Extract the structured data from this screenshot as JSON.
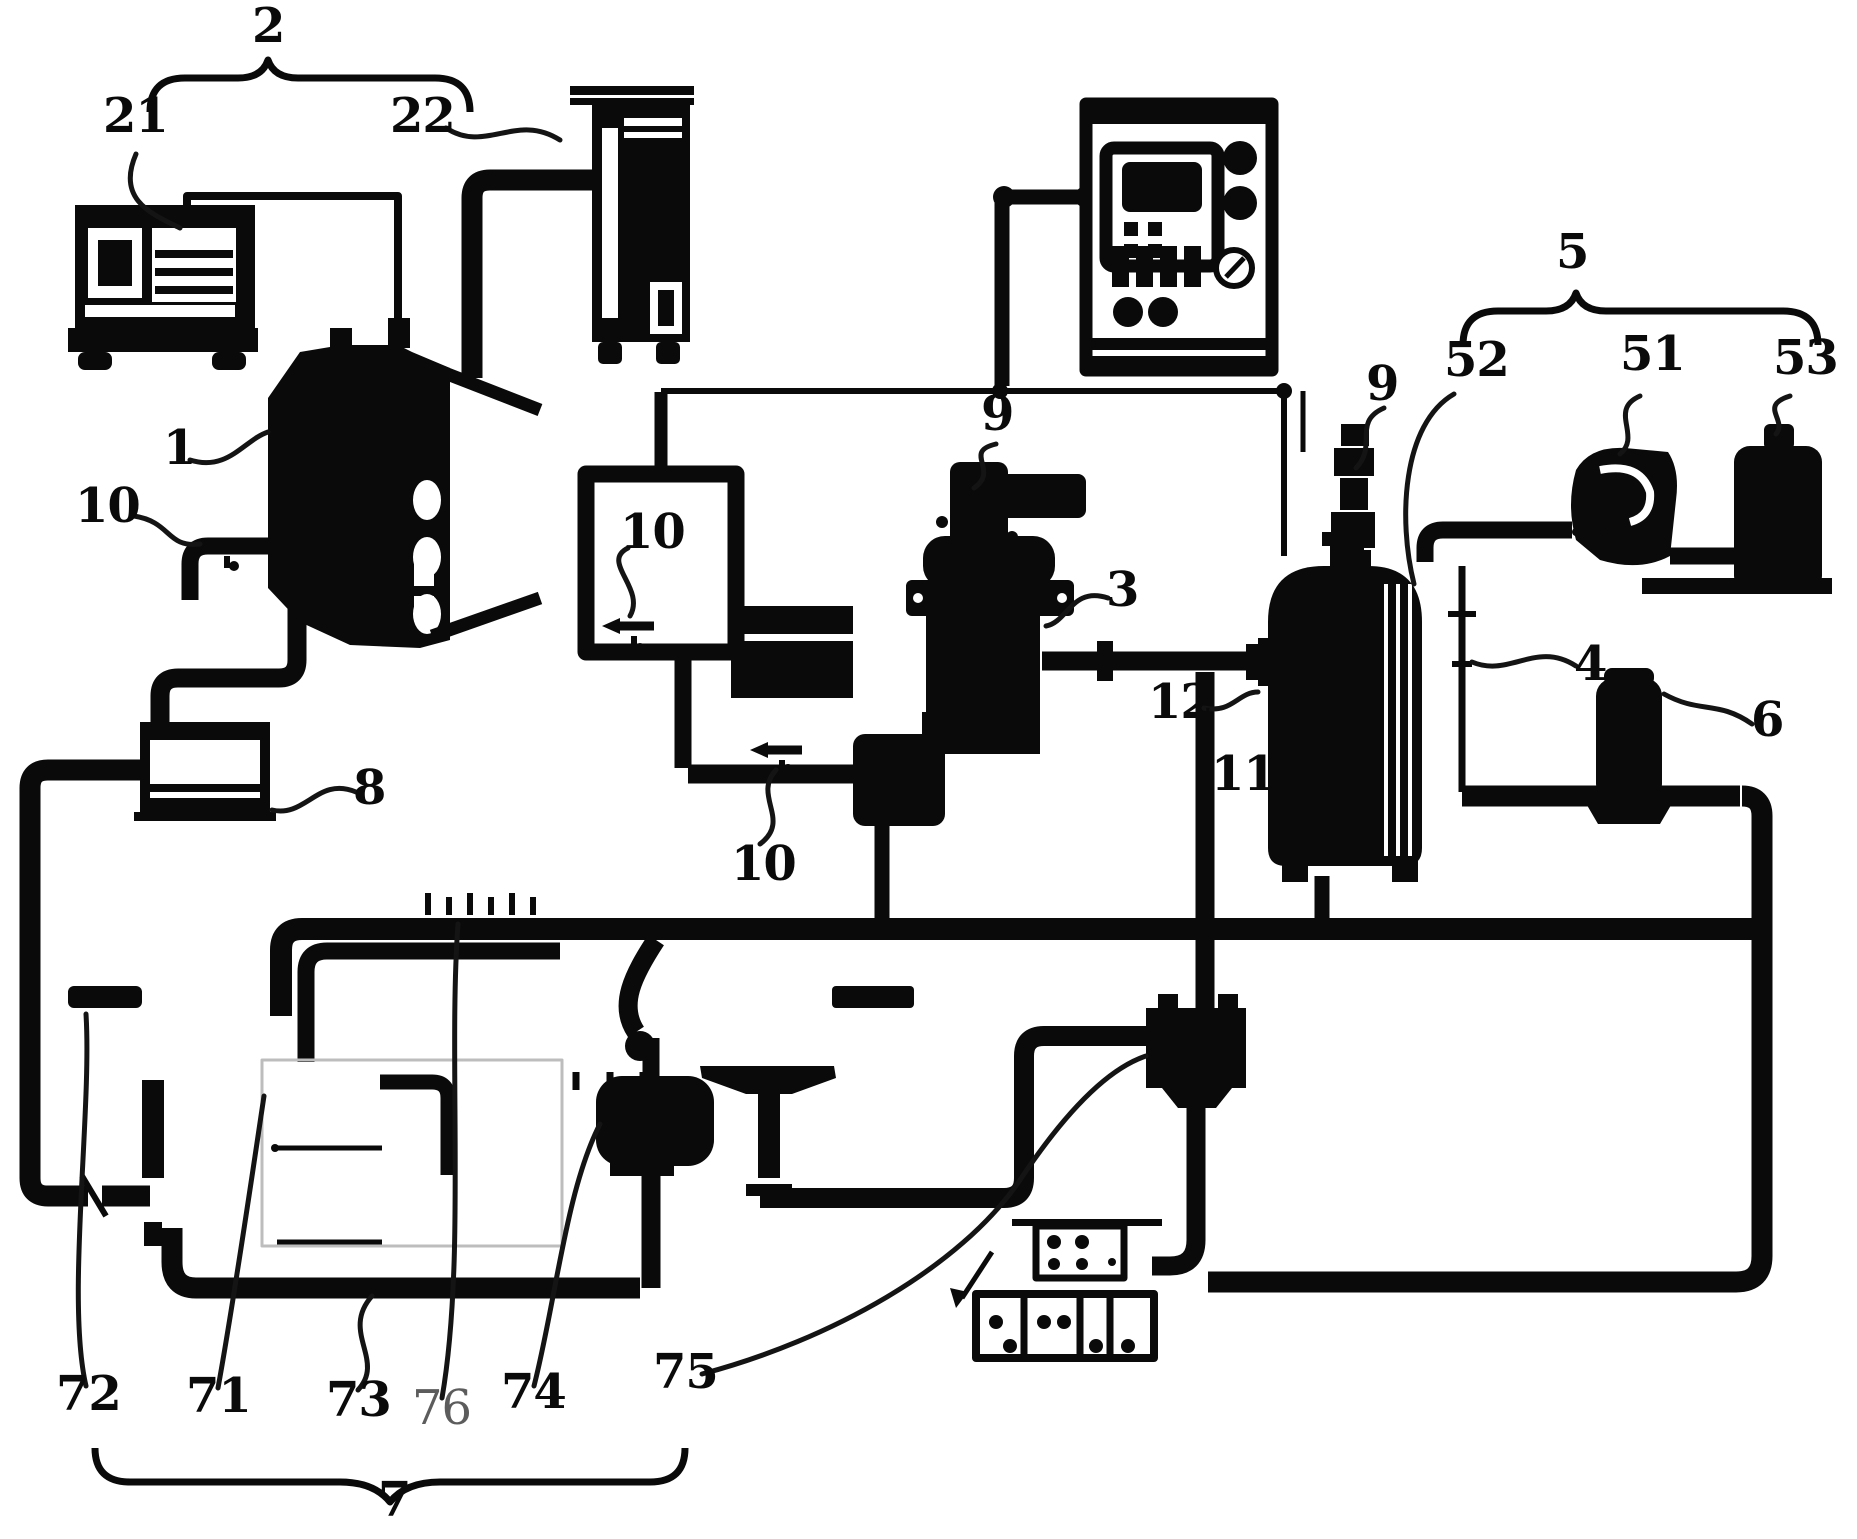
{
  "figure": {
    "kind": "patent-style engine lubrication / test-rig schematic, black line art on white",
    "colors": {
      "ink": "#0a0a0a",
      "paper": "#ffffff",
      "muted_label": "#5c5c5c"
    },
    "labels": [
      {
        "id": "2",
        "text": "2",
        "x": 252,
        "y": 2
      },
      {
        "id": "21",
        "text": "21",
        "x": 103,
        "y": 92
      },
      {
        "id": "22",
        "text": "22",
        "x": 390,
        "y": 92
      },
      {
        "id": "1",
        "text": "1",
        "x": 163,
        "y": 424
      },
      {
        "id": "10a",
        "text": "10",
        "x": 75,
        "y": 482
      },
      {
        "id": "10b",
        "text": "10",
        "x": 620,
        "y": 508
      },
      {
        "id": "10c",
        "text": "10",
        "x": 731,
        "y": 840
      },
      {
        "id": "9a",
        "text": "9",
        "x": 981,
        "y": 390
      },
      {
        "id": "3",
        "text": "3",
        "x": 1106,
        "y": 566
      },
      {
        "id": "12",
        "text": "12",
        "x": 1148,
        "y": 678
      },
      {
        "id": "11",
        "text": "11",
        "x": 1211,
        "y": 750
      },
      {
        "id": "9b",
        "text": "9",
        "x": 1366,
        "y": 360
      },
      {
        "id": "52",
        "text": "52",
        "x": 1444,
        "y": 336
      },
      {
        "id": "5",
        "text": "5",
        "x": 1556,
        "y": 228
      },
      {
        "id": "51",
        "text": "51",
        "x": 1620,
        "y": 330
      },
      {
        "id": "53",
        "text": "53",
        "x": 1773,
        "y": 334
      },
      {
        "id": "4",
        "text": "4",
        "x": 1574,
        "y": 640
      },
      {
        "id": "6",
        "text": "6",
        "x": 1751,
        "y": 696
      },
      {
        "id": "8",
        "text": "8",
        "x": 353,
        "y": 764
      },
      {
        "id": "72",
        "text": "72",
        "x": 56,
        "y": 1370
      },
      {
        "id": "71",
        "text": "71",
        "x": 186,
        "y": 1372
      },
      {
        "id": "73",
        "text": "73",
        "x": 326,
        "y": 1376
      },
      {
        "id": "76",
        "text": "76",
        "x": 412,
        "y": 1384,
        "muted": true
      },
      {
        "id": "74",
        "text": "74",
        "x": 501,
        "y": 1368
      },
      {
        "id": "75",
        "text": "75",
        "x": 653,
        "y": 1348
      },
      {
        "id": "7",
        "text": "7",
        "x": 378,
        "y": 1476
      }
    ],
    "groups": [
      {
        "brace": "2",
        "members": [
          "21",
          "22"
        ]
      },
      {
        "brace": "5",
        "members": [
          "52",
          "51",
          "53"
        ]
      },
      {
        "brace": "7",
        "members": [
          "72",
          "71",
          "73",
          "76",
          "74",
          "75"
        ]
      }
    ]
  }
}
